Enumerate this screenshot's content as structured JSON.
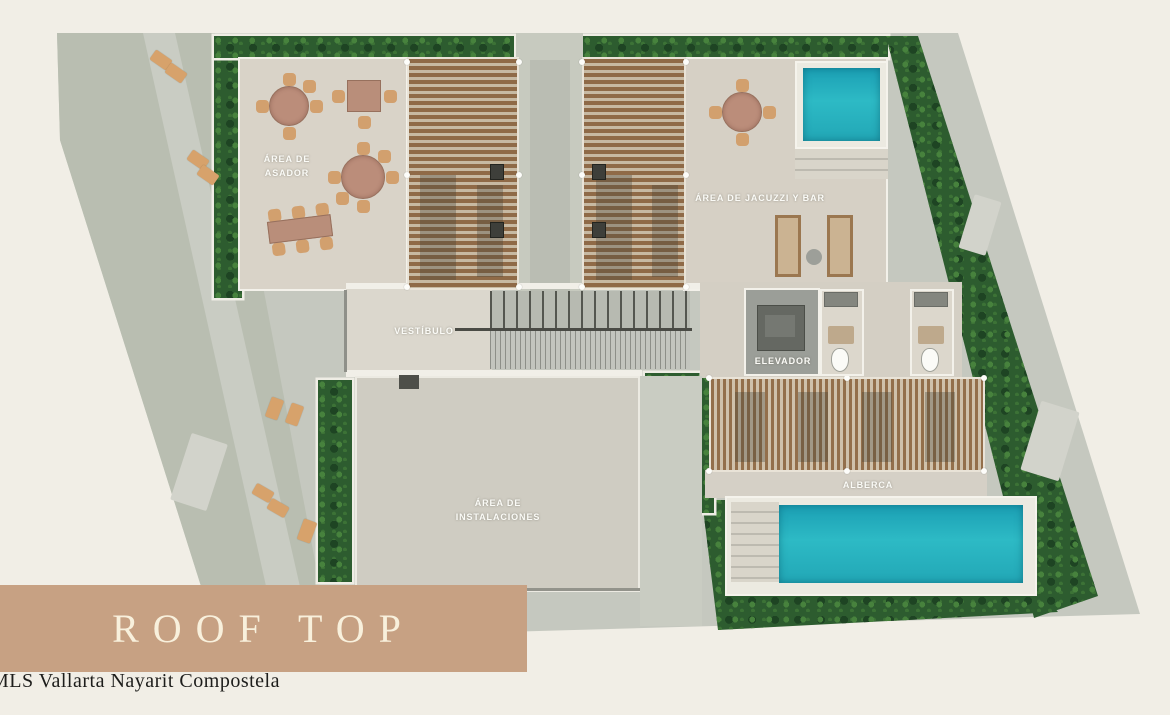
{
  "floor_plan": {
    "areas": {
      "asador": {
        "line1": "ÁREA DE",
        "line2": "ASADOR"
      },
      "jacuzzi_bar": {
        "label": "ÁREA DE JACUZZI Y BAR"
      },
      "vestibulo": {
        "label": "VESTÍBULO"
      },
      "elevador": {
        "label": "ELEVADOR"
      },
      "instalaciones": {
        "line1": "ÁREA DE",
        "line2": "INSTALACIONES"
      },
      "alberca": {
        "label": "ALBERCA"
      }
    },
    "colors": {
      "background": "#f1eee6",
      "terrace_gray": "#c5c8bf",
      "roof_beige": "#d9d3c8",
      "greenery": "#2d5c2f",
      "pergola_wood": "#8f6a47",
      "pool_water": "#29b2bf",
      "wall_white": "#f3f1ea",
      "banner": "#c7a183",
      "banner_text": "#f8f0dc"
    }
  },
  "banner": {
    "label": "ROOF TOP"
  },
  "watermark": {
    "text": "MLS Vallarta Nayarit Compostela"
  }
}
